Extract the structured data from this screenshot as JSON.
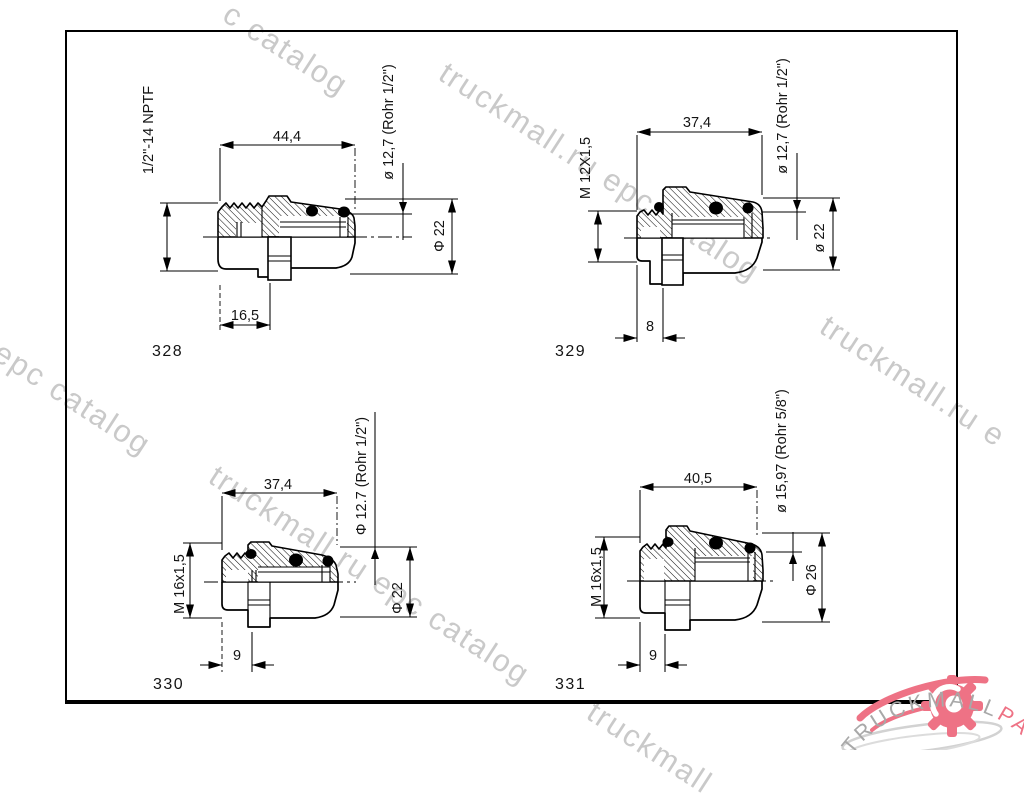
{
  "watermarks": {
    "fragments": [
      "c catalog",
      "truckmall.ru epc catalog",
      "truckmall.ru e",
      "l epc catalog",
      "truckmall.ru epc catalog",
      "truckmall"
    ]
  },
  "logo": {
    "brand_gray": "TRUCKMALL",
    "brand_pink": "PARTS",
    "gray_color": "#a8a8a8",
    "pink_color": "#ee7285"
  },
  "drawings": [
    {
      "part": "328",
      "length": "44,4",
      "length2": "16,5",
      "thread": "1/2\"-14 NPTF",
      "tube": "ø 12,7 (Rohr 1/2\")",
      "od": "Φ 22"
    },
    {
      "part": "329",
      "length": "37,4",
      "length2": "8",
      "thread": "M 12X1,5",
      "tube": "ø 12,7 (Rohr 1/2\")",
      "od": "ø 22"
    },
    {
      "part": "330",
      "length": "37,4",
      "length2": "9",
      "thread": "M 16x1,5",
      "tube": "Φ 12.7 (Rohr 1/2\")",
      "od": "Φ 22"
    },
    {
      "part": "331",
      "length": "40,5",
      "length2": "9",
      "thread": "M 16x1,5",
      "tube": "ø 15,97 (Rohr 5/8\")",
      "od": "Φ 26"
    }
  ]
}
